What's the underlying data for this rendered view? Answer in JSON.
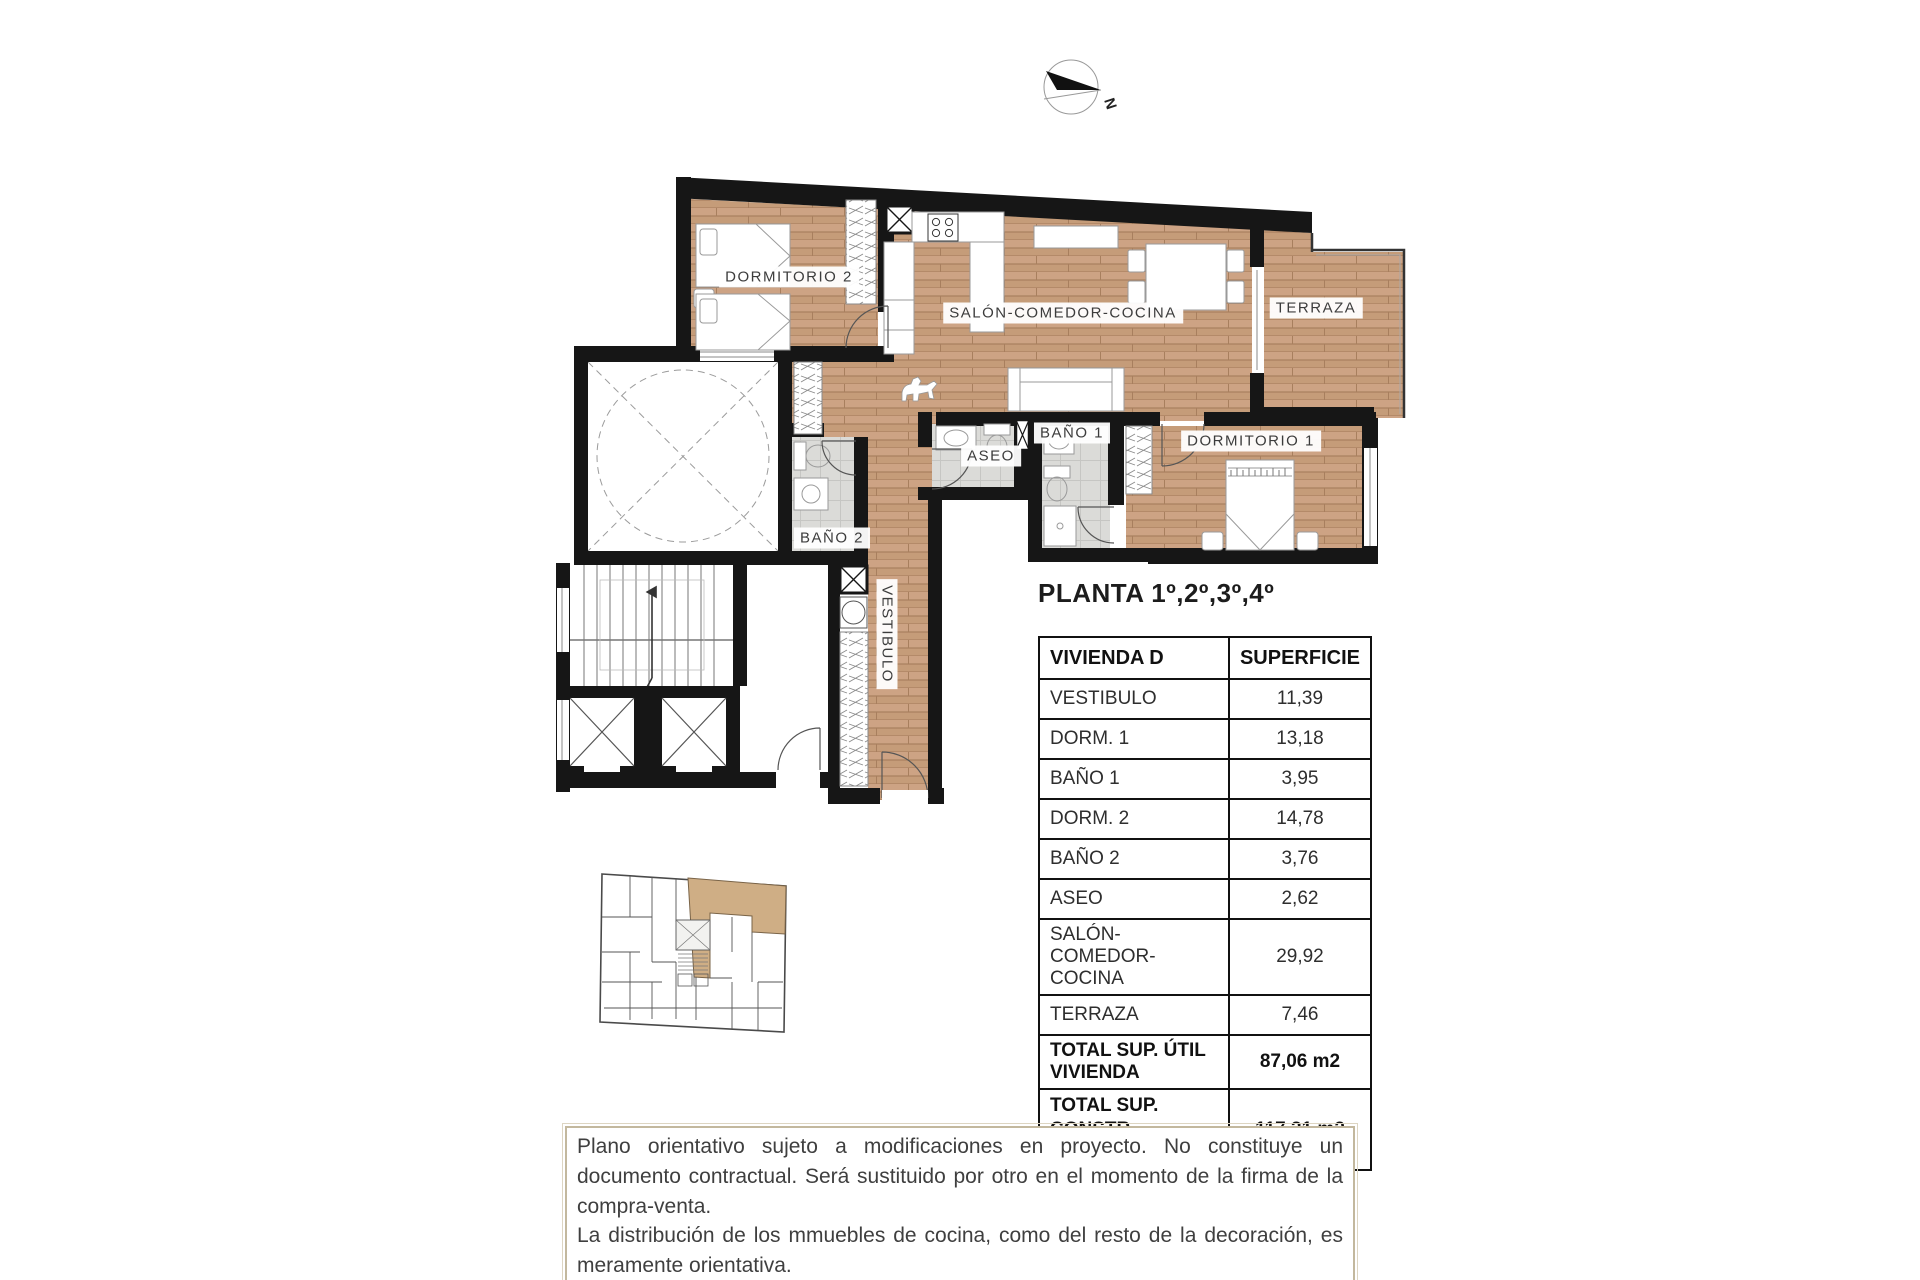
{
  "compass": {
    "north_label": "N"
  },
  "title": "PLANTA 1º,2º,3º,4º",
  "plan": {
    "rooms": [
      {
        "label": "DORMITORIO 2"
      },
      {
        "label": "SALÓN-COMEDOR-COCINA"
      },
      {
        "label": "TERRAZA"
      },
      {
        "label": "DORMITORIO 1"
      },
      {
        "label": "BAÑO 1"
      },
      {
        "label": "ASEO"
      },
      {
        "label": "BAÑO 2"
      },
      {
        "label": "VESTIBULO"
      }
    ]
  },
  "table": {
    "header": {
      "col1": "VIVIENDA D",
      "col2": "SUPERFICIE"
    },
    "rows": [
      {
        "label": "VESTIBULO",
        "value": "11,39"
      },
      {
        "label": "DORM. 1",
        "value": "13,18"
      },
      {
        "label": "BAÑO 1",
        "value": "3,95"
      },
      {
        "label": "DORM. 2",
        "value": "14,78"
      },
      {
        "label": "BAÑO 2",
        "value": "3,76"
      },
      {
        "label": "ASEO",
        "value": "2,62"
      },
      {
        "label": "SALÓN-COMEDOR-COCINA",
        "value": "29,92"
      },
      {
        "label": "TERRAZA",
        "value": "7,46"
      }
    ],
    "totals": [
      {
        "label": "TOTAL SUP. ÚTIL VIVIENDA",
        "value": "87,06 m2"
      },
      {
        "label_line1": "TOTAL SUP. CONSTR.",
        "label_line2": "VIV + PP +ZC",
        "value": "117,31 m2"
      }
    ]
  },
  "disclaimer": {
    "line1": "Plano orientativo sujeto a modificaciones en proyecto. No constituye un documento contractual. Será sustituido por otro en el momento de la firma de la compra-venta.",
    "line2": "La distribución de los mmuebles de cocina, como del resto de la decoración, es meramente orientativa."
  },
  "colors": {
    "wall": "#161616",
    "wood": "#c59c79",
    "wood_seam": "#a87f5e",
    "tile": "#dbdbd8",
    "tile_line": "#c6c6c3",
    "unit_highlight": "#cfae85",
    "disclaimer_border": "#c3b89e"
  }
}
